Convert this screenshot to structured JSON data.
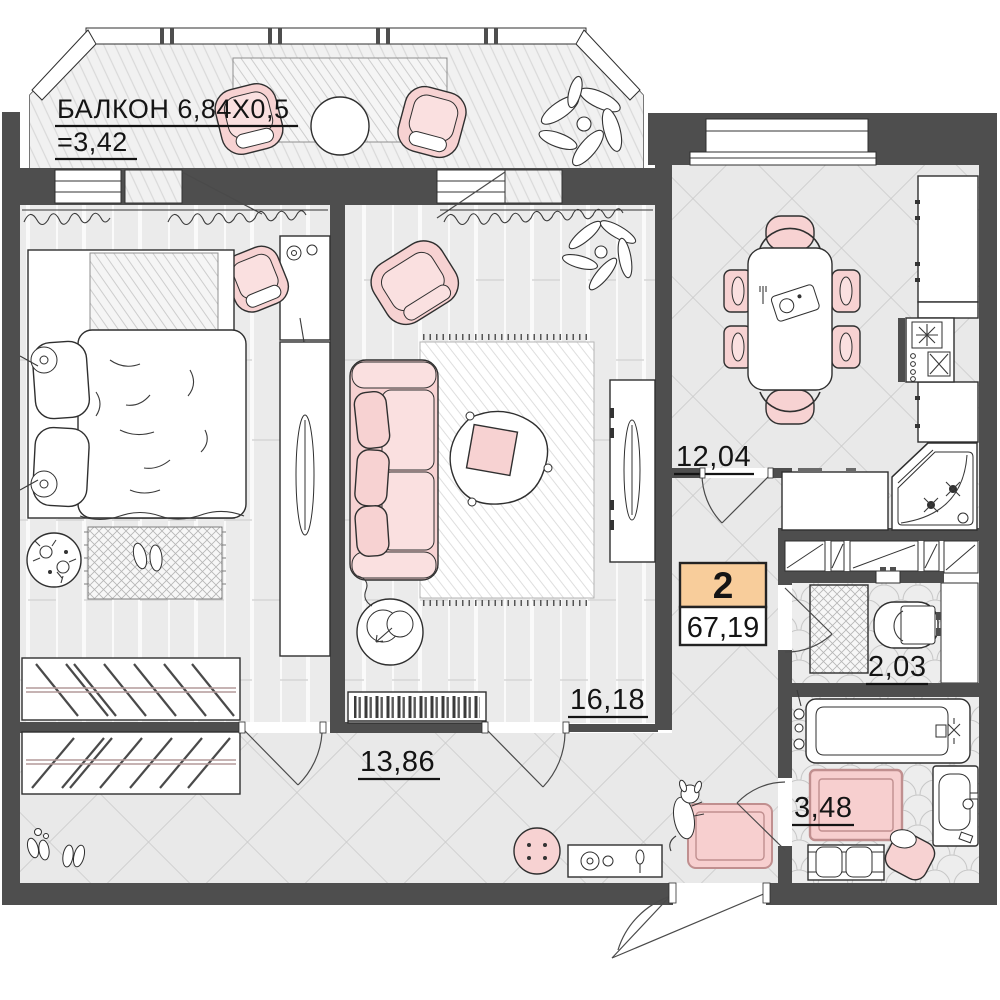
{
  "title": "2-room apartment floor plan",
  "balcony": {
    "label_line1": "БАЛКОН 6,84Х0,5",
    "label_line2": "=3,42"
  },
  "rooms": {
    "kitchen": {
      "name": "kitchen",
      "area": "12,04"
    },
    "living_room": {
      "name": "living room",
      "area": "16,18"
    },
    "hallway": {
      "name": "hallway",
      "area": "13,86"
    },
    "wc": {
      "name": "wc",
      "area": "2,03"
    },
    "bathroom": {
      "name": "bathroom",
      "area": "3,48"
    }
  },
  "badge": {
    "rooms_count": "2",
    "total_area_m2": "67,19"
  },
  "colors": {
    "wall": "#4e4e4e",
    "furniture_pink": "#f7d2d2",
    "badge_orange": "#f8cd9b",
    "floor_tile_line": "#cccccc"
  }
}
